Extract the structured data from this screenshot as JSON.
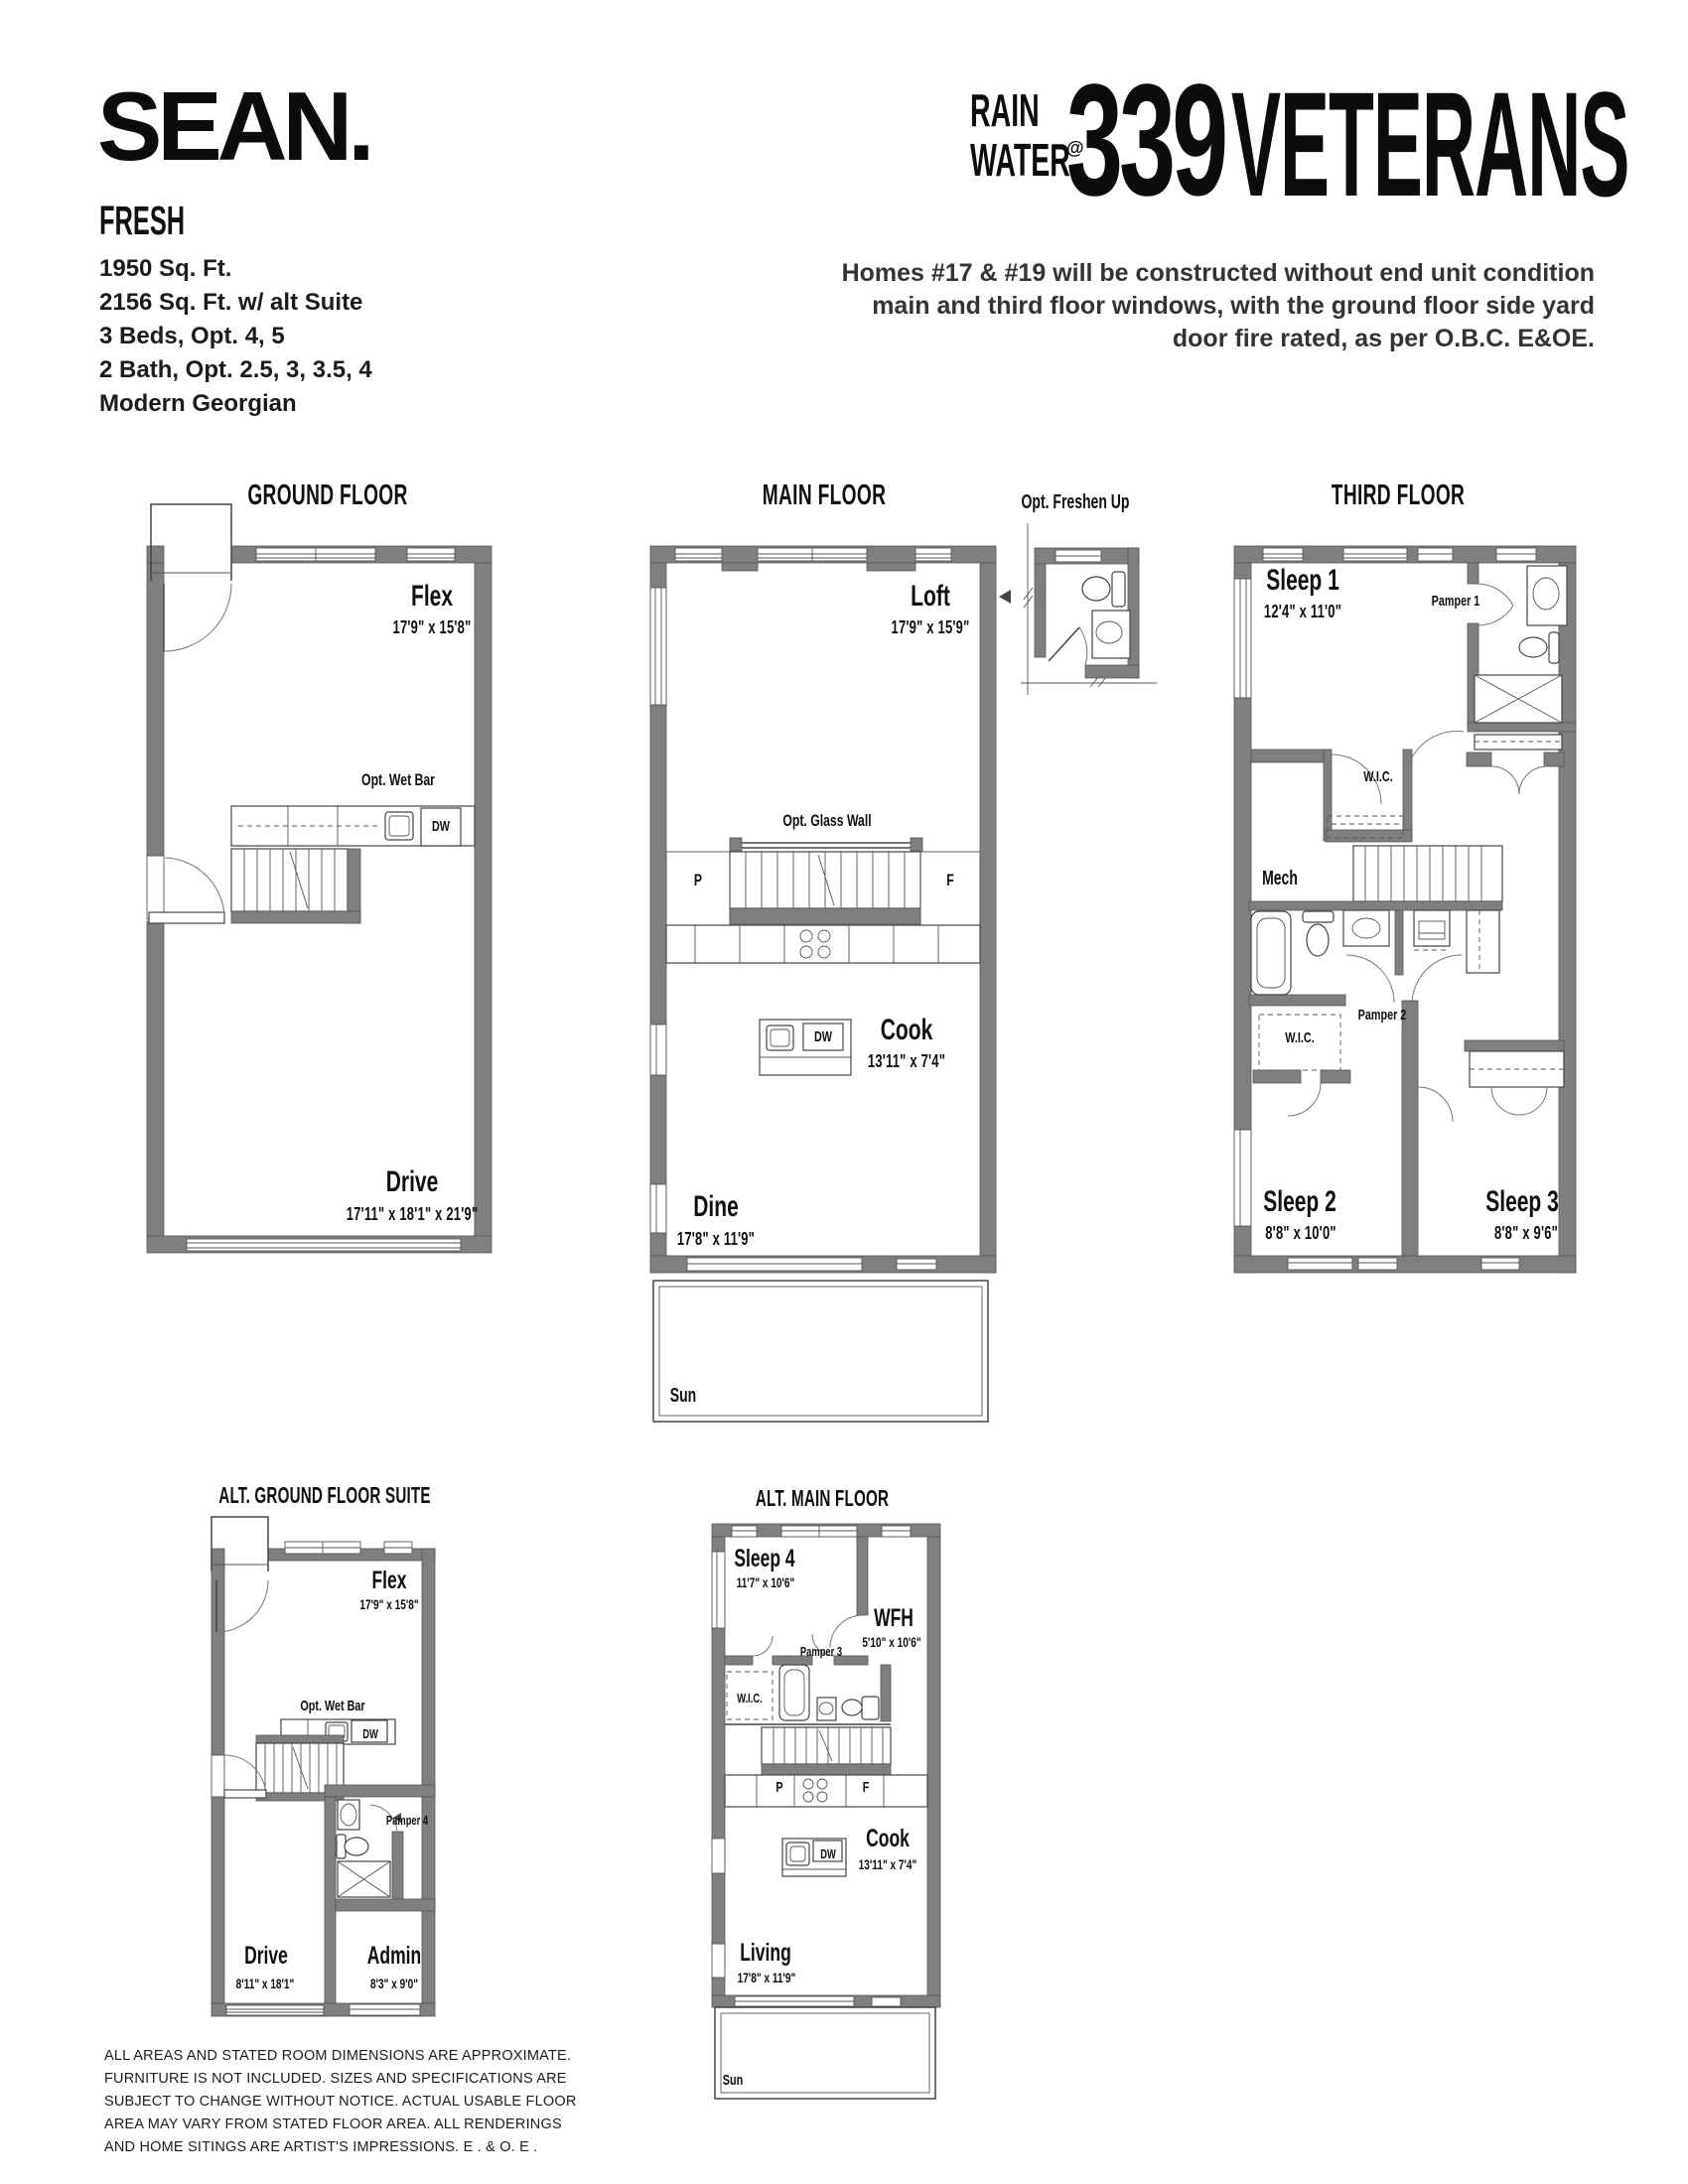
{
  "header": {
    "brand": "SEAN.",
    "collection": "FRESH",
    "specs": [
      "1950 Sq. Ft.",
      "2156 Sq. Ft. w/ alt Suite",
      "3 Beds, Opt. 4, 5",
      "2 Bath, Opt. 2.5, 3, 3.5, 4",
      "Modern Georgian"
    ],
    "logo": {
      "rain": "RAIN",
      "water": "WATER",
      "at": "@",
      "number": "339",
      "street": "VETERANS"
    },
    "note": "Homes #17 & #19 will be constructed without end unit condition main and third floor windows, with the ground floor side yard door fire rated, as per O.B.C. E&OE."
  },
  "plans": {
    "ground": {
      "title": "GROUND FLOOR",
      "flex_name": "Flex",
      "flex_dim": "17'9\" x 15'8\"",
      "wet_bar": "Opt. Wet Bar",
      "dw": "DW",
      "drive_name": "Drive",
      "drive_dim": "17'11\" x 18'1\" x 21'9\""
    },
    "main": {
      "title": "MAIN FLOOR",
      "loft_name": "Loft",
      "loft_dim": "17'9\" x 15'9\"",
      "glass_wall": "Opt. Glass Wall",
      "pantry": "P",
      "fridge": "F",
      "dw": "DW",
      "cook_name": "Cook",
      "cook_dim": "13'11\" x 7'4\"",
      "dine_name": "Dine",
      "dine_dim": "17'8\" x 11'9\"",
      "sun": "Sun"
    },
    "freshen": {
      "title": "Opt. Freshen Up"
    },
    "third": {
      "title": "THIRD FLOOR",
      "sleep1_name": "Sleep 1",
      "sleep1_dim": "12'4\" x 11'0\"",
      "pamper1": "Pamper 1",
      "wic1": "W.I.C.",
      "mech": "Mech",
      "pamper2": "Pamper 2",
      "wic2": "W.I.C.",
      "sleep2_name": "Sleep 2",
      "sleep2_dim": "8'8\" x 10'0\"",
      "sleep3_name": "Sleep 3",
      "sleep3_dim": "8'8\" x 9'6\""
    },
    "alt_ground": {
      "title": "ALT. GROUND FLOOR SUITE",
      "flex_name": "Flex",
      "flex_dim": "17'9\" x 15'8\"",
      "wet_bar": "Opt. Wet Bar",
      "dw": "DW",
      "pamper4": "Pamper 4",
      "drive_name": "Drive",
      "drive_dim": "8'11\" x 18'1\"",
      "admin_name": "Admin",
      "admin_dim": "8'3\" x 9'0\""
    },
    "alt_main": {
      "title": "ALT. MAIN FLOOR",
      "sleep4_name": "Sleep 4",
      "sleep4_dim": "11'7\" x 10'6\"",
      "wfh_name": "WFH",
      "wfh_dim": "5'10\" x 10'6\"",
      "pamper3": "Pamper 3",
      "wic": "W.I.C.",
      "pantry": "P",
      "fridge": "F",
      "dw": "DW",
      "cook_name": "Cook",
      "cook_dim": "13'11\" x 7'4\"",
      "living_name": "Living",
      "living_dim": "17'8\" x 11'9\"",
      "sun": "Sun"
    }
  },
  "disclaimer": "ALL AREAS AND STATED ROOM DIMENSIONS ARE APPROXIMATE. FURNITURE IS NOT INCLUDED. SIZES AND SPECIFICATIONS ARE SUBJECT TO CHANGE WITHOUT NOTICE. ACTUAL USABLE FLOOR AREA MAY VARY FROM STATED FLOOR AREA. ALL RENDERINGS AND HOME SITINGS ARE ARTIST'S IMPRESSIONS. E . & O. E ."
}
